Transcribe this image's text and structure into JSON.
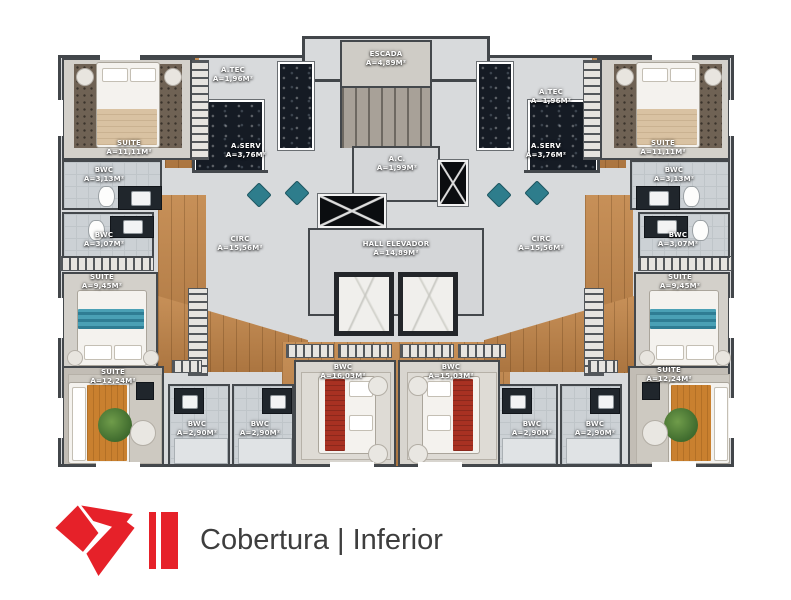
{
  "footer": {
    "title": "Cobertura | Inferior",
    "accent_color": "#e62129"
  },
  "colors": {
    "accent_red": "#e62129",
    "wall": "#42464a",
    "wood_floor": "#bf8a50",
    "dark_marble": "#151b24",
    "teal_furniture": "#2e7d8c"
  },
  "plan": {
    "rooms": {
      "escada": {
        "name": "ESCADA",
        "area": "A=4,89M²"
      },
      "atec_left": {
        "name": "A.TEC",
        "area": "A=1,96M²"
      },
      "atec_right": {
        "name": "A.TEC",
        "area": "A=1,96M²"
      },
      "aserv_left": {
        "name": "A.SERV",
        "area": "A=3,76M²"
      },
      "aserv_right": {
        "name": "A.SERV",
        "area": "A=3,76M²"
      },
      "ac": {
        "name": "A.C.",
        "area": "A=1,99M²"
      },
      "hall": {
        "name": "HALL ELEVADOR",
        "area": "A=14,89M²"
      },
      "circ_left": {
        "name": "CIRC",
        "area": "A=15,56M²"
      },
      "circ_right": {
        "name": "CIRC",
        "area": "A=15,56M²"
      },
      "suite_top_left": {
        "name": "SUITE",
        "area": "A=11,11M²"
      },
      "suite_top_right": {
        "name": "SUITE",
        "area": "A=11,11M²"
      },
      "bwc_313_left": {
        "name": "BWC",
        "area": "A=3,13M²"
      },
      "bwc_313_right": {
        "name": "BWC",
        "area": "A=3,13M²"
      },
      "bwc_307_left": {
        "name": "BWC",
        "area": "A=3,07M²"
      },
      "bwc_307_right": {
        "name": "BWC",
        "area": "A=3,07M²"
      },
      "suite_mid_left": {
        "name": "SUITE",
        "area": "A=9,45M²"
      },
      "suite_mid_right": {
        "name": "SUITE",
        "area": "A=9,45M²"
      },
      "suite_bottom_left": {
        "name": "SUITE",
        "area": "A=12,24M²"
      },
      "suite_bottom_right": {
        "name": "SUITE",
        "area": "A=12,24M²"
      },
      "bwc_290_left_1": {
        "name": "BWC",
        "area": "A=2,90M²"
      },
      "bwc_290_left_2": {
        "name": "BWC",
        "area": "A=2,90M²"
      },
      "bwc_290_right_1": {
        "name": "BWC",
        "area": "A=2,90M²"
      },
      "bwc_290_right_2": {
        "name": "BWC",
        "area": "A=2,90M²"
      },
      "bedroom_center_left": {
        "name": "BWC",
        "area": "A=16,03M²"
      },
      "bedroom_center_right": {
        "name": "BWC",
        "area": "A=15,03M²"
      }
    }
  }
}
